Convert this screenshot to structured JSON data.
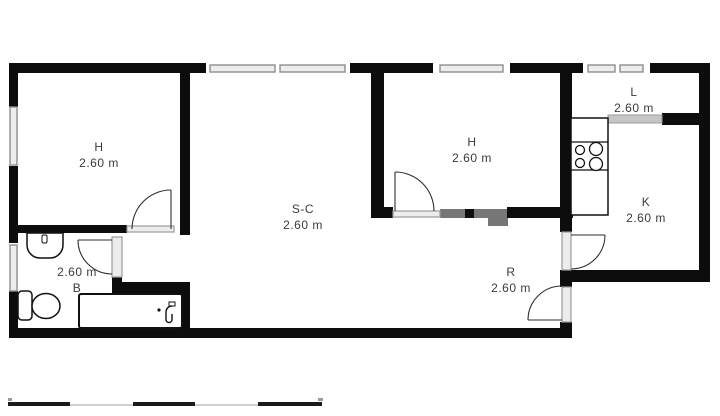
{
  "plan": {
    "title": "apartment-floor-plan",
    "rooms": {
      "h_top_left": {
        "label": "H",
        "dimension": "2.60 m"
      },
      "s_c": {
        "label": "S-C",
        "dimension": "2.60 m"
      },
      "h_center": {
        "label": "H",
        "dimension": "2.60 m"
      },
      "l": {
        "label": "L",
        "dimension": "2.60 m"
      },
      "k": {
        "label": "K",
        "dimension": "2.60 m"
      },
      "r": {
        "label": "R",
        "dimension": "2.60 m"
      },
      "b": {
        "label": "B",
        "dimension": "2.60 m"
      }
    },
    "fixtures": [
      "bathtub",
      "toilet",
      "washbasin",
      "stove",
      "kitchen-counter"
    ],
    "colors": {
      "wall": "#0d0d0d",
      "window": "#ececec",
      "window_frame": "#8f8f8f",
      "threshold": "#ececec",
      "background": "#ffffff",
      "label": "#3b3b3b",
      "partition_gray": "#777777"
    },
    "scale_bar": {
      "segments": 5
    }
  }
}
